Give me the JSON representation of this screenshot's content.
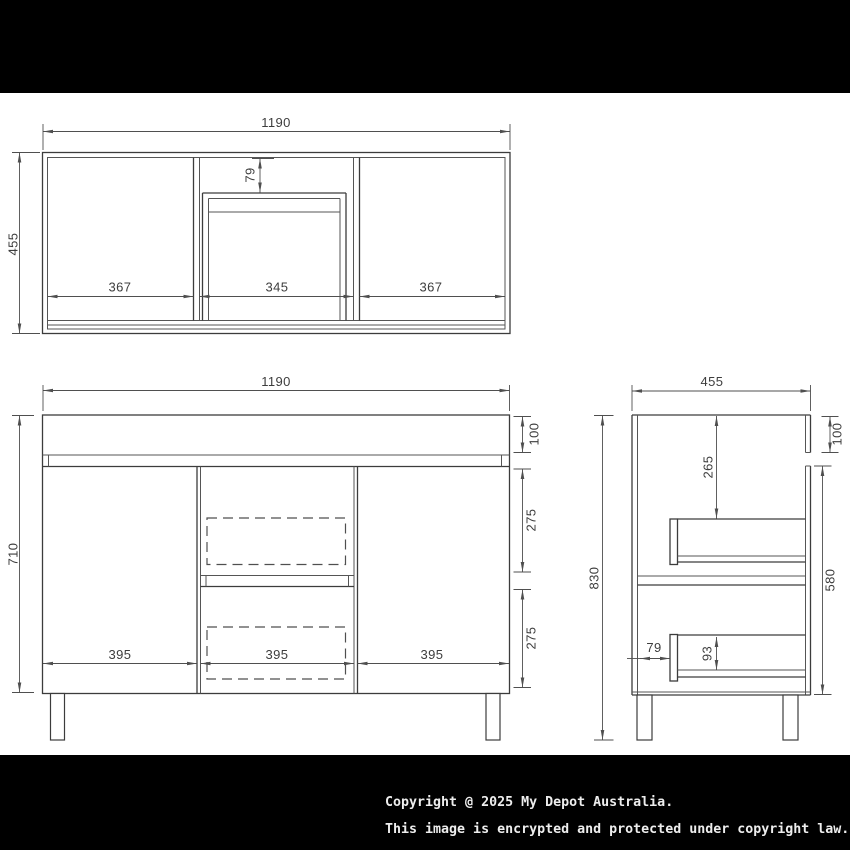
{
  "drawing": {
    "top_view": {
      "width": "1190",
      "depth": "455",
      "sections": {
        "left": "367",
        "middle": "345",
        "right": "367"
      },
      "drawer_offset": "79"
    },
    "front_view": {
      "width": "1190",
      "body_height": "710",
      "sections": {
        "left": "395",
        "middle": "395",
        "right": "395"
      },
      "benchtop_height": "100",
      "upper_drawer": "275",
      "lower_drawer": "275"
    },
    "side_view": {
      "depth": "455",
      "total_height": "830",
      "benchtop_height": "100",
      "drawer_top_offset": "265",
      "carcass_height": "580",
      "drawer_back_gap": "79",
      "drawer_side_height": "93"
    }
  },
  "footer": {
    "line1": "Copyright @ 2025 My Depot Australia.",
    "line2": "This image is encrypted and protected under copyright law."
  },
  "colors": {
    "background": "#ffffff",
    "band": "#000000",
    "line": "#3c3c3c",
    "dimension": "#4f4f4f",
    "footer_text": "#ededed"
  }
}
